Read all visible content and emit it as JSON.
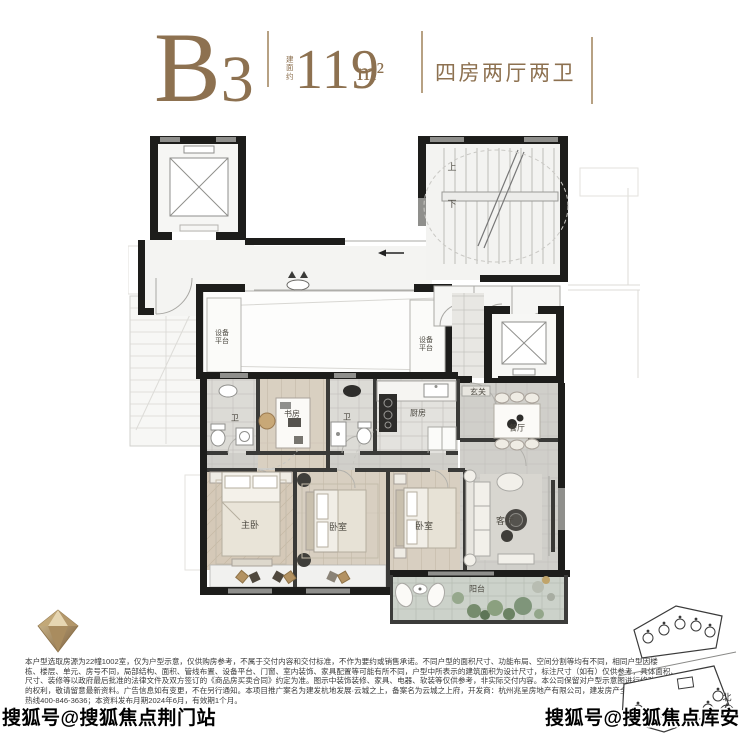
{
  "header": {
    "model": "B",
    "model_sub": "3",
    "area_label": "建面约",
    "area_value": "119",
    "area_unit": "m²",
    "layout": "四房两厅两卫",
    "accent_color": "#8d7150"
  },
  "floorplan": {
    "rooms": {
      "master": "主卧",
      "bedroom_a": "卧室",
      "bedroom_b": "卧室",
      "study": "书房",
      "bath1": "卫",
      "bath2": "卫",
      "kitchen": "厨房",
      "dining": "餐厅",
      "living": "客厅",
      "entry": "玄关",
      "balcony": "阳台",
      "equipment_left": "设备平台",
      "equipment_right": "设备平台",
      "stair_up": "上",
      "stair_down": "下"
    },
    "wall_color": "#1d1d1b"
  },
  "siteplan": {
    "north": "北"
  },
  "disclaimer": {
    "lines": [
      "本户型选取房源为22幢1002室，仅为户型示意，仅供购房参考，不属于交付内容和交付标准，不作为要约或销售承诺。不同户型的面积尺寸、功能布局、空间分割等均有不同，相同户型因楼",
      "栋、楼层、单元、房号不同，局部结构、面积、管线布置、设备平台、门窗、室内装饰、家具配置等可能有所不同，户型中所表示的建筑面积为设计尺寸，标注尺寸（如有）仅供参考，具体面积、",
      "尺寸、装修等以政府最后批准的法律文件及双方签订的《商品房买卖合同》约定为准。图示中装饰装修、家具、电器、软装等仅供参考，非实际交付内容。本公司保留对户型示意图进行修改",
      "的权利，敬请留意最新资料。广告信息如有变更，不在另行通知。本项目推广案名为建发杭地发展·云城之上，备案名为云城之上府，开发商：杭州兆呈房地产有限公司，建发房产全国服务",
      "热线400-846-3636；本资料发布月期2024年6月，有效期1个月。"
    ]
  },
  "watermarks": {
    "bottom_left": "搜狐号@搜狐焦点荆门站",
    "bottom_right": "搜狐号@搜狐焦点库安站"
  }
}
